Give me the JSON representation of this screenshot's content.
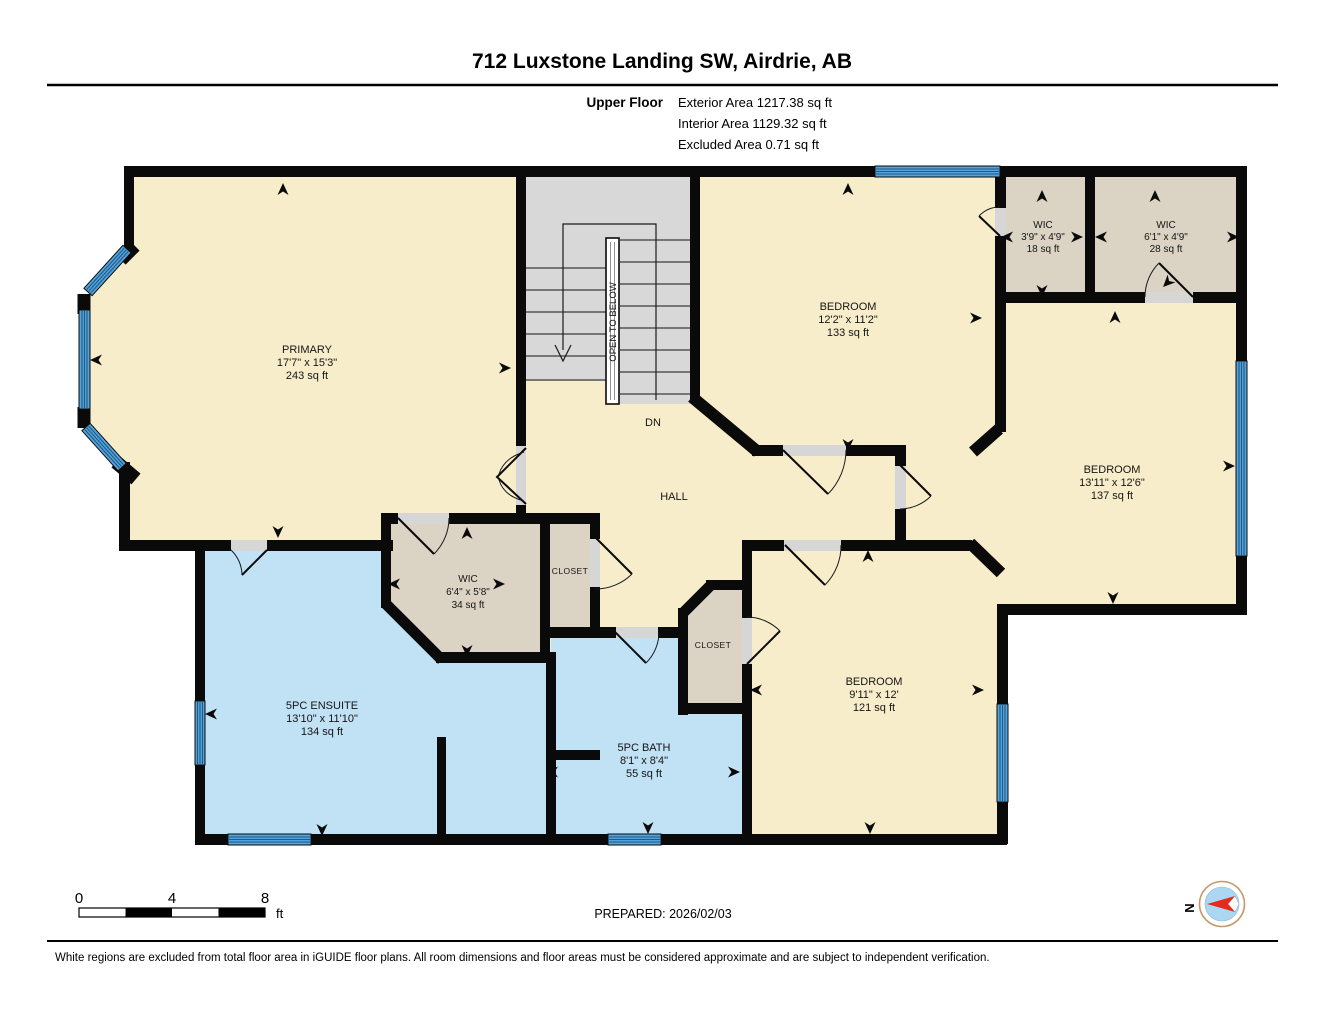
{
  "header": {
    "title": "712 Luxstone Landing SW, Airdrie, AB"
  },
  "floor": {
    "name": "Upper Floor",
    "exterior": "Exterior Area 1217.38 sq ft",
    "interior": "Interior Area 1129.32 sq ft",
    "excluded": "Excluded Area 0.71 sq ft"
  },
  "rooms": [
    {
      "name": "PRIMARY",
      "dims": "17'7\" x 15'3\"",
      "area": "243 sq ft"
    },
    {
      "name": "BEDROOM",
      "dims": "12'2\" x 11'2\"",
      "area": "133 sq ft"
    },
    {
      "name": "WIC",
      "dims": "3'9\" x 4'9\"",
      "area": "18 sq ft"
    },
    {
      "name": "WIC",
      "dims": "6'1\" x 4'9\"",
      "area": "28 sq ft"
    },
    {
      "name": "BEDROOM",
      "dims": "13'11\" x 12'6\"",
      "area": "137 sq ft"
    },
    {
      "name": "BEDROOM",
      "dims": "9'11\" x 12'",
      "area": "121 sq ft"
    },
    {
      "name": "5PC ENSUITE",
      "dims": "13'10\" x 11'10\"",
      "area": "134 sq ft"
    },
    {
      "name": "5PC BATH",
      "dims": "8'1\" x 8'4\"",
      "area": "55 sq ft"
    },
    {
      "name": "WIC",
      "dims": "6'4\" x 5'8\"",
      "area": "34 sq ft"
    }
  ],
  "labels": {
    "hall": "HALL",
    "down": "DN",
    "open_to_below": "OPEN TO BELOW",
    "closet1": "CLOSET",
    "closet2": "CLOSET",
    "north": "N"
  },
  "scale_bar": {
    "ticks": [
      "0",
      "4",
      "8"
    ],
    "unit": "ft"
  },
  "footer": {
    "prepared": "PREPARED: 2026/02/03",
    "disclaimer": "White regions are excluded from total floor area in iGUIDE floor plans. All room dimensions and floor areas must be considered approximate and are subject to independent verification."
  },
  "colors": {
    "room_fill": "#F8EDCB",
    "closet_fill": "#DBD3C4",
    "bath_fill": "#C1E1F5",
    "stairs_fill": "#D8D8D8",
    "wall": "#0A0A0A",
    "window_blue": "#55A3DA",
    "window_stripe": "#1C5A88",
    "compass_red": "#E32B1E",
    "compass_blue": "#ABD7F2"
  }
}
